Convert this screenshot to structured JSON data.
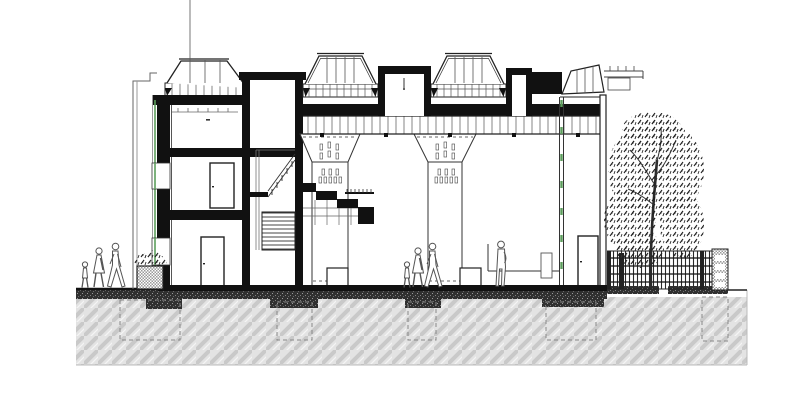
{
  "meta": {
    "title": "Building cross-section (architectural drawing)",
    "drawing_type": "section elevation",
    "text_labels": []
  },
  "colors": {
    "ink": "#1a1a1a",
    "line_gray": "#555555",
    "accent_green": "#5d9e5d",
    "ground_fill": "#e3e3e3",
    "ground_stripe": "#c9c9c9",
    "dark_hatch": "#303030",
    "paper": "#ffffff"
  },
  "scene": {
    "left_annex": {
      "stories": 3,
      "doors": 2,
      "windows": 2,
      "skylight_monitors": 1
    },
    "stair_tower": {
      "flights": 2,
      "cantilever_steps": 4
    },
    "hall": {
      "skylight_monitors": 2,
      "roof_boxes": 2,
      "tilted_monitor": 1,
      "mushroom_columns": 2,
      "fixture_clusters_per_column": 2,
      "pedestals": 2,
      "glazed_screen": 1,
      "door": 1
    },
    "site": {
      "tree": 1,
      "fence_bays": 1,
      "fence_pier_slots": 4,
      "planter": 1,
      "foundation_pads": 5,
      "people_outside": 3,
      "people_inside": 4
    }
  }
}
